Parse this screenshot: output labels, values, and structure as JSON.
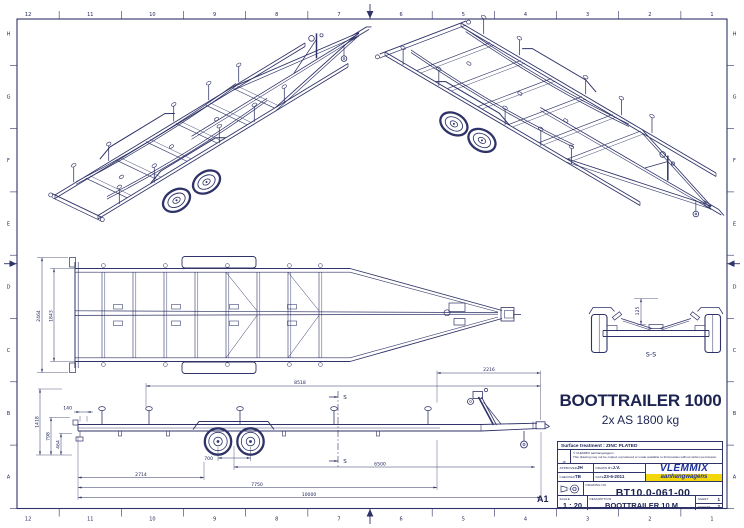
{
  "sheet": {
    "format": "A1",
    "grid_cols": [
      "12",
      "11",
      "10",
      "9",
      "8",
      "7",
      "6",
      "5",
      "4",
      "3",
      "2",
      "1"
    ],
    "grid_rows": [
      "H",
      "G",
      "F",
      "E",
      "D",
      "C",
      "B",
      "A"
    ]
  },
  "title": {
    "main": "BOOTTRAILER 1000",
    "sub": "2x AS 1800 kg"
  },
  "brand": {
    "name": "VLEMMIX",
    "tagline": "aanhangwagens",
    "blue": "#1b2f9e",
    "yellow": "#f2d70a"
  },
  "tb": {
    "surface": "Surface treatment : ZINC PLATED",
    "cell_tag": "JP",
    "copyright1": "© VLEMMIX aanhangwagens",
    "copyright2": "This drawing may not be copied, reproduced or made available to third parties without written permission.",
    "approved_label": "APPROVED",
    "approved": "JH",
    "checked_label": "CHECKED",
    "checked": "TB",
    "drawn_label": "DRAWN BY",
    "drawn": "J.V.",
    "date_label": "DATE",
    "date": "23-6-2011",
    "drawingno_label": "DRAWING NO.",
    "drawing_no": "BT10.0-061-00",
    "scale_label": "SCALE",
    "scale": "1 : 20",
    "description_label": "DESCRIPTION",
    "description": "BOOTTRAILER 10 M",
    "sheet_label": "SHEET",
    "sheet_no": "1",
    "sheets_label": "SHEETS",
    "sheets": "2"
  },
  "views": {
    "section_label": "S-S",
    "section_marker": "S"
  },
  "dims": {
    "overall_width": "2464",
    "inner_width": "1843",
    "top_length": "8518",
    "front_overhang": "2216",
    "axle_spacing": "700",
    "rear_to_axle": "2714",
    "axle_to_coupling": "6500",
    "rear_to_winch": "7750",
    "total_length": "10000",
    "rear_offset": "140",
    "winch_height": "1418",
    "frame_height": "798",
    "hub_height": "464",
    "section_height": "125"
  },
  "colors": {
    "line": "#2f3367",
    "text": "#20265a"
  }
}
